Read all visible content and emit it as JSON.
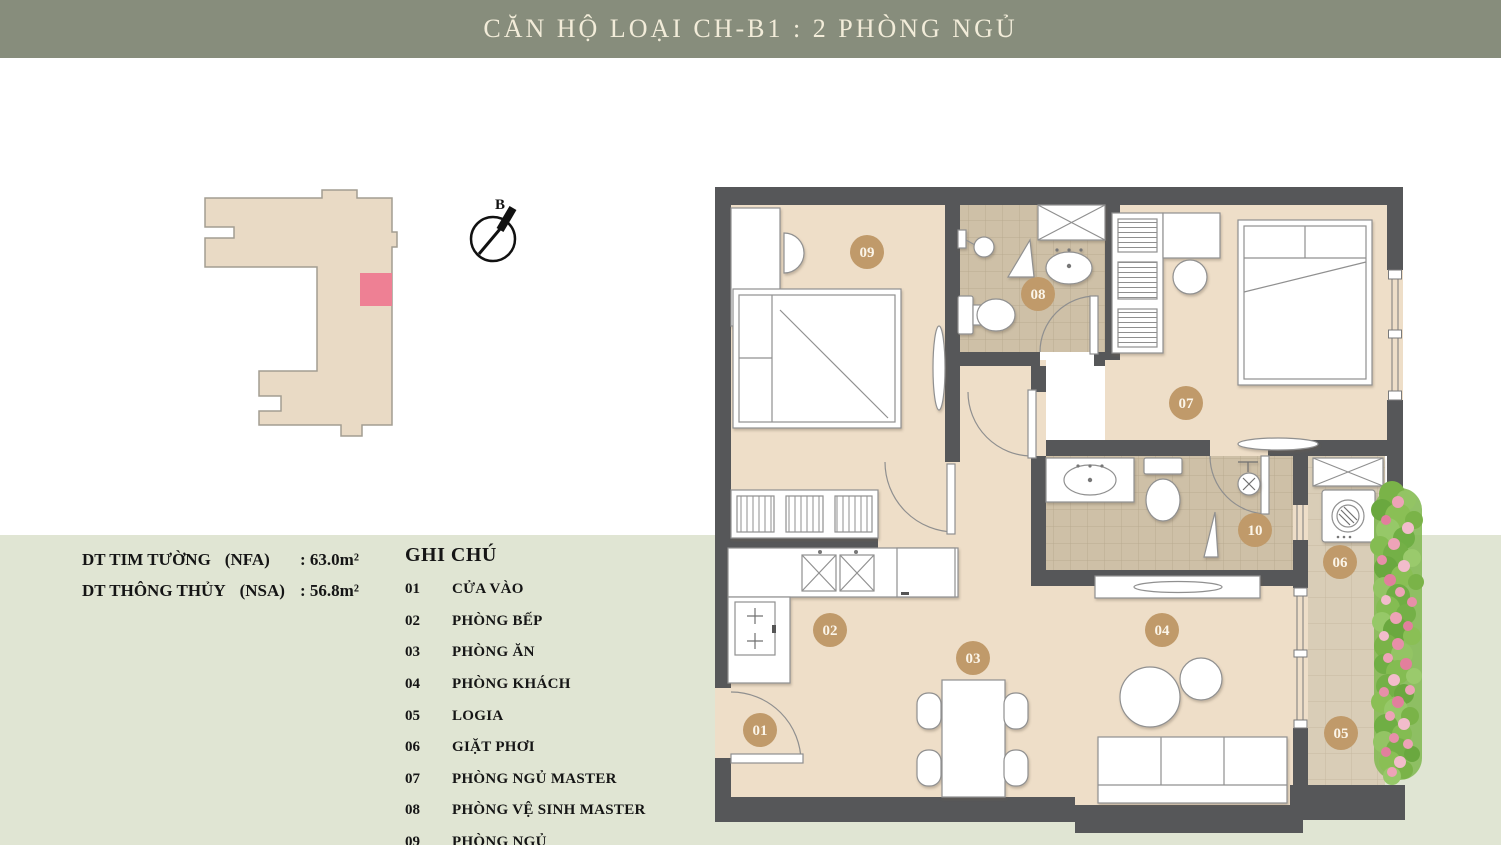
{
  "header": {
    "title": "CĂN HỘ LOẠI CH-B1 : 2 PHÒNG NGỦ"
  },
  "overview": {
    "compass_label": "B"
  },
  "area_info": {
    "rows": [
      {
        "label": "DT TIM TƯỜNG",
        "code": "(NFA)",
        "value": ": 63.0m²"
      },
      {
        "label": "DT THÔNG THỦY",
        "code": "(NSA)",
        "value": ": 56.8m²"
      }
    ]
  },
  "legend": {
    "title": "GHI CHÚ",
    "items": [
      {
        "num": "01",
        "label": "CỬA VÀO"
      },
      {
        "num": "02",
        "label": "PHÒNG BẾP"
      },
      {
        "num": "03",
        "label": "PHÒNG ĂN"
      },
      {
        "num": "04",
        "label": "PHÒNG KHÁCH"
      },
      {
        "num": "05",
        "label": "LOGIA"
      },
      {
        "num": "06",
        "label": "GIẶT PHƠI"
      },
      {
        "num": "07",
        "label": "PHÒNG NGỦ MASTER"
      },
      {
        "num": "08",
        "label": "PHÒNG VỆ SINH MASTER"
      },
      {
        "num": "09",
        "label": "PHÒNG NGỦ"
      }
    ]
  },
  "plan": {
    "badges": [
      {
        "num": "01"
      },
      {
        "num": "02"
      },
      {
        "num": "03"
      },
      {
        "num": "04"
      },
      {
        "num": "05"
      },
      {
        "num": "06"
      },
      {
        "num": "07"
      },
      {
        "num": "08"
      },
      {
        "num": "09"
      },
      {
        "num": "10"
      }
    ]
  },
  "colors": {
    "header_bg": "#878d7c",
    "title_text": "#f2ecd9",
    "background_green": "#e0e5d3",
    "wall": "#565759",
    "floor_beige": "#eedec8",
    "bath_tile": "#cec0a7",
    "logia_tile": "#d9cdb7",
    "badge": "#c09a6a",
    "unit_highlight": "#ee8094",
    "building_fill": "#e9dac5",
    "foliage_green": "#7ab348",
    "flower_pink": "#eda3b7"
  }
}
